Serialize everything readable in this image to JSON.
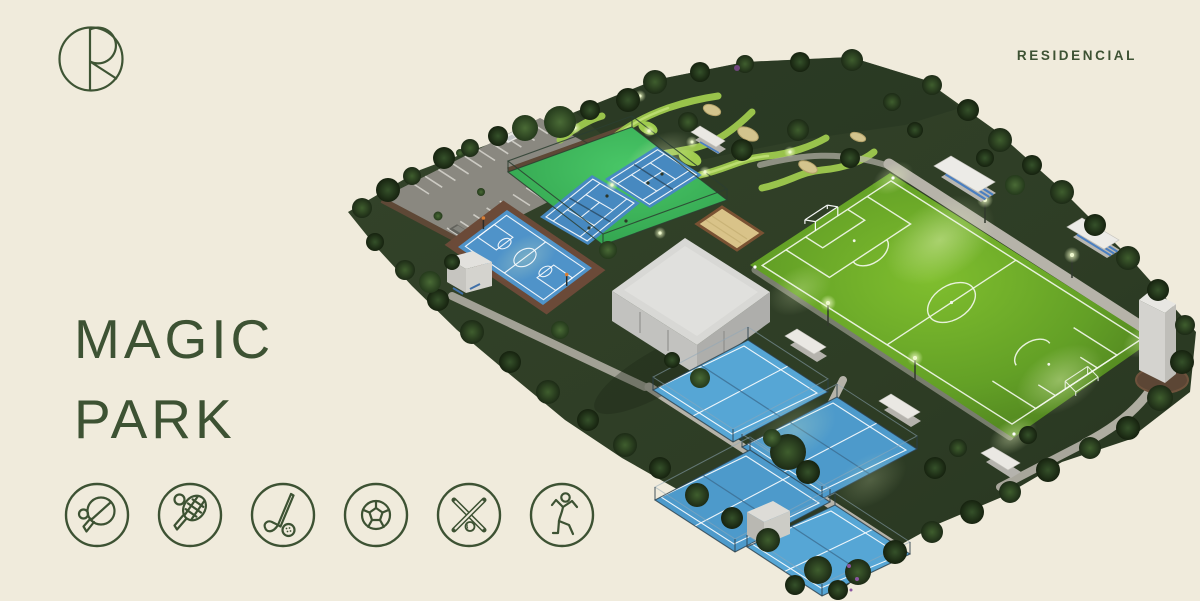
{
  "brand": {
    "logo_label": "R monogram logo",
    "wordmark": "RESIDENCIAL"
  },
  "title": {
    "line1": "MAGIC",
    "line2": "PARK"
  },
  "colors": {
    "background": "#f0ebdc",
    "brand_green": "#3d5233",
    "land_green": "#2e3d25",
    "soccer_green_bright": "#7fbe2e",
    "soccer_green_dark": "#4e8120",
    "tennis_compound_green": "#3cb85c",
    "tennis_court_blue": "#4789c0",
    "basketball_blue": "#4f93c9",
    "padel_blue": "#56a6d5",
    "sand": "#d9c389",
    "parking_gray": "#8f8c84",
    "path_gray": "#b6b3a9",
    "roof_white": "#eae8e3",
    "bleacher_seat_blue": "#4a7fc0"
  },
  "amenities": [
    {
      "name": "table-tennis"
    },
    {
      "name": "tennis"
    },
    {
      "name": "golf"
    },
    {
      "name": "soccer"
    },
    {
      "name": "baseball"
    },
    {
      "name": "gymnastics"
    }
  ],
  "park": {
    "features": [
      "parking-lot",
      "mini-golf-course",
      "tennis-courts",
      "basketball-court",
      "clubhouse-building",
      "beach-volleyball-court",
      "soccer-field",
      "padel-courts",
      "bleachers",
      "dugout-shelters",
      "observation-tower",
      "tree-border",
      "walkways",
      "floodlights"
    ]
  }
}
